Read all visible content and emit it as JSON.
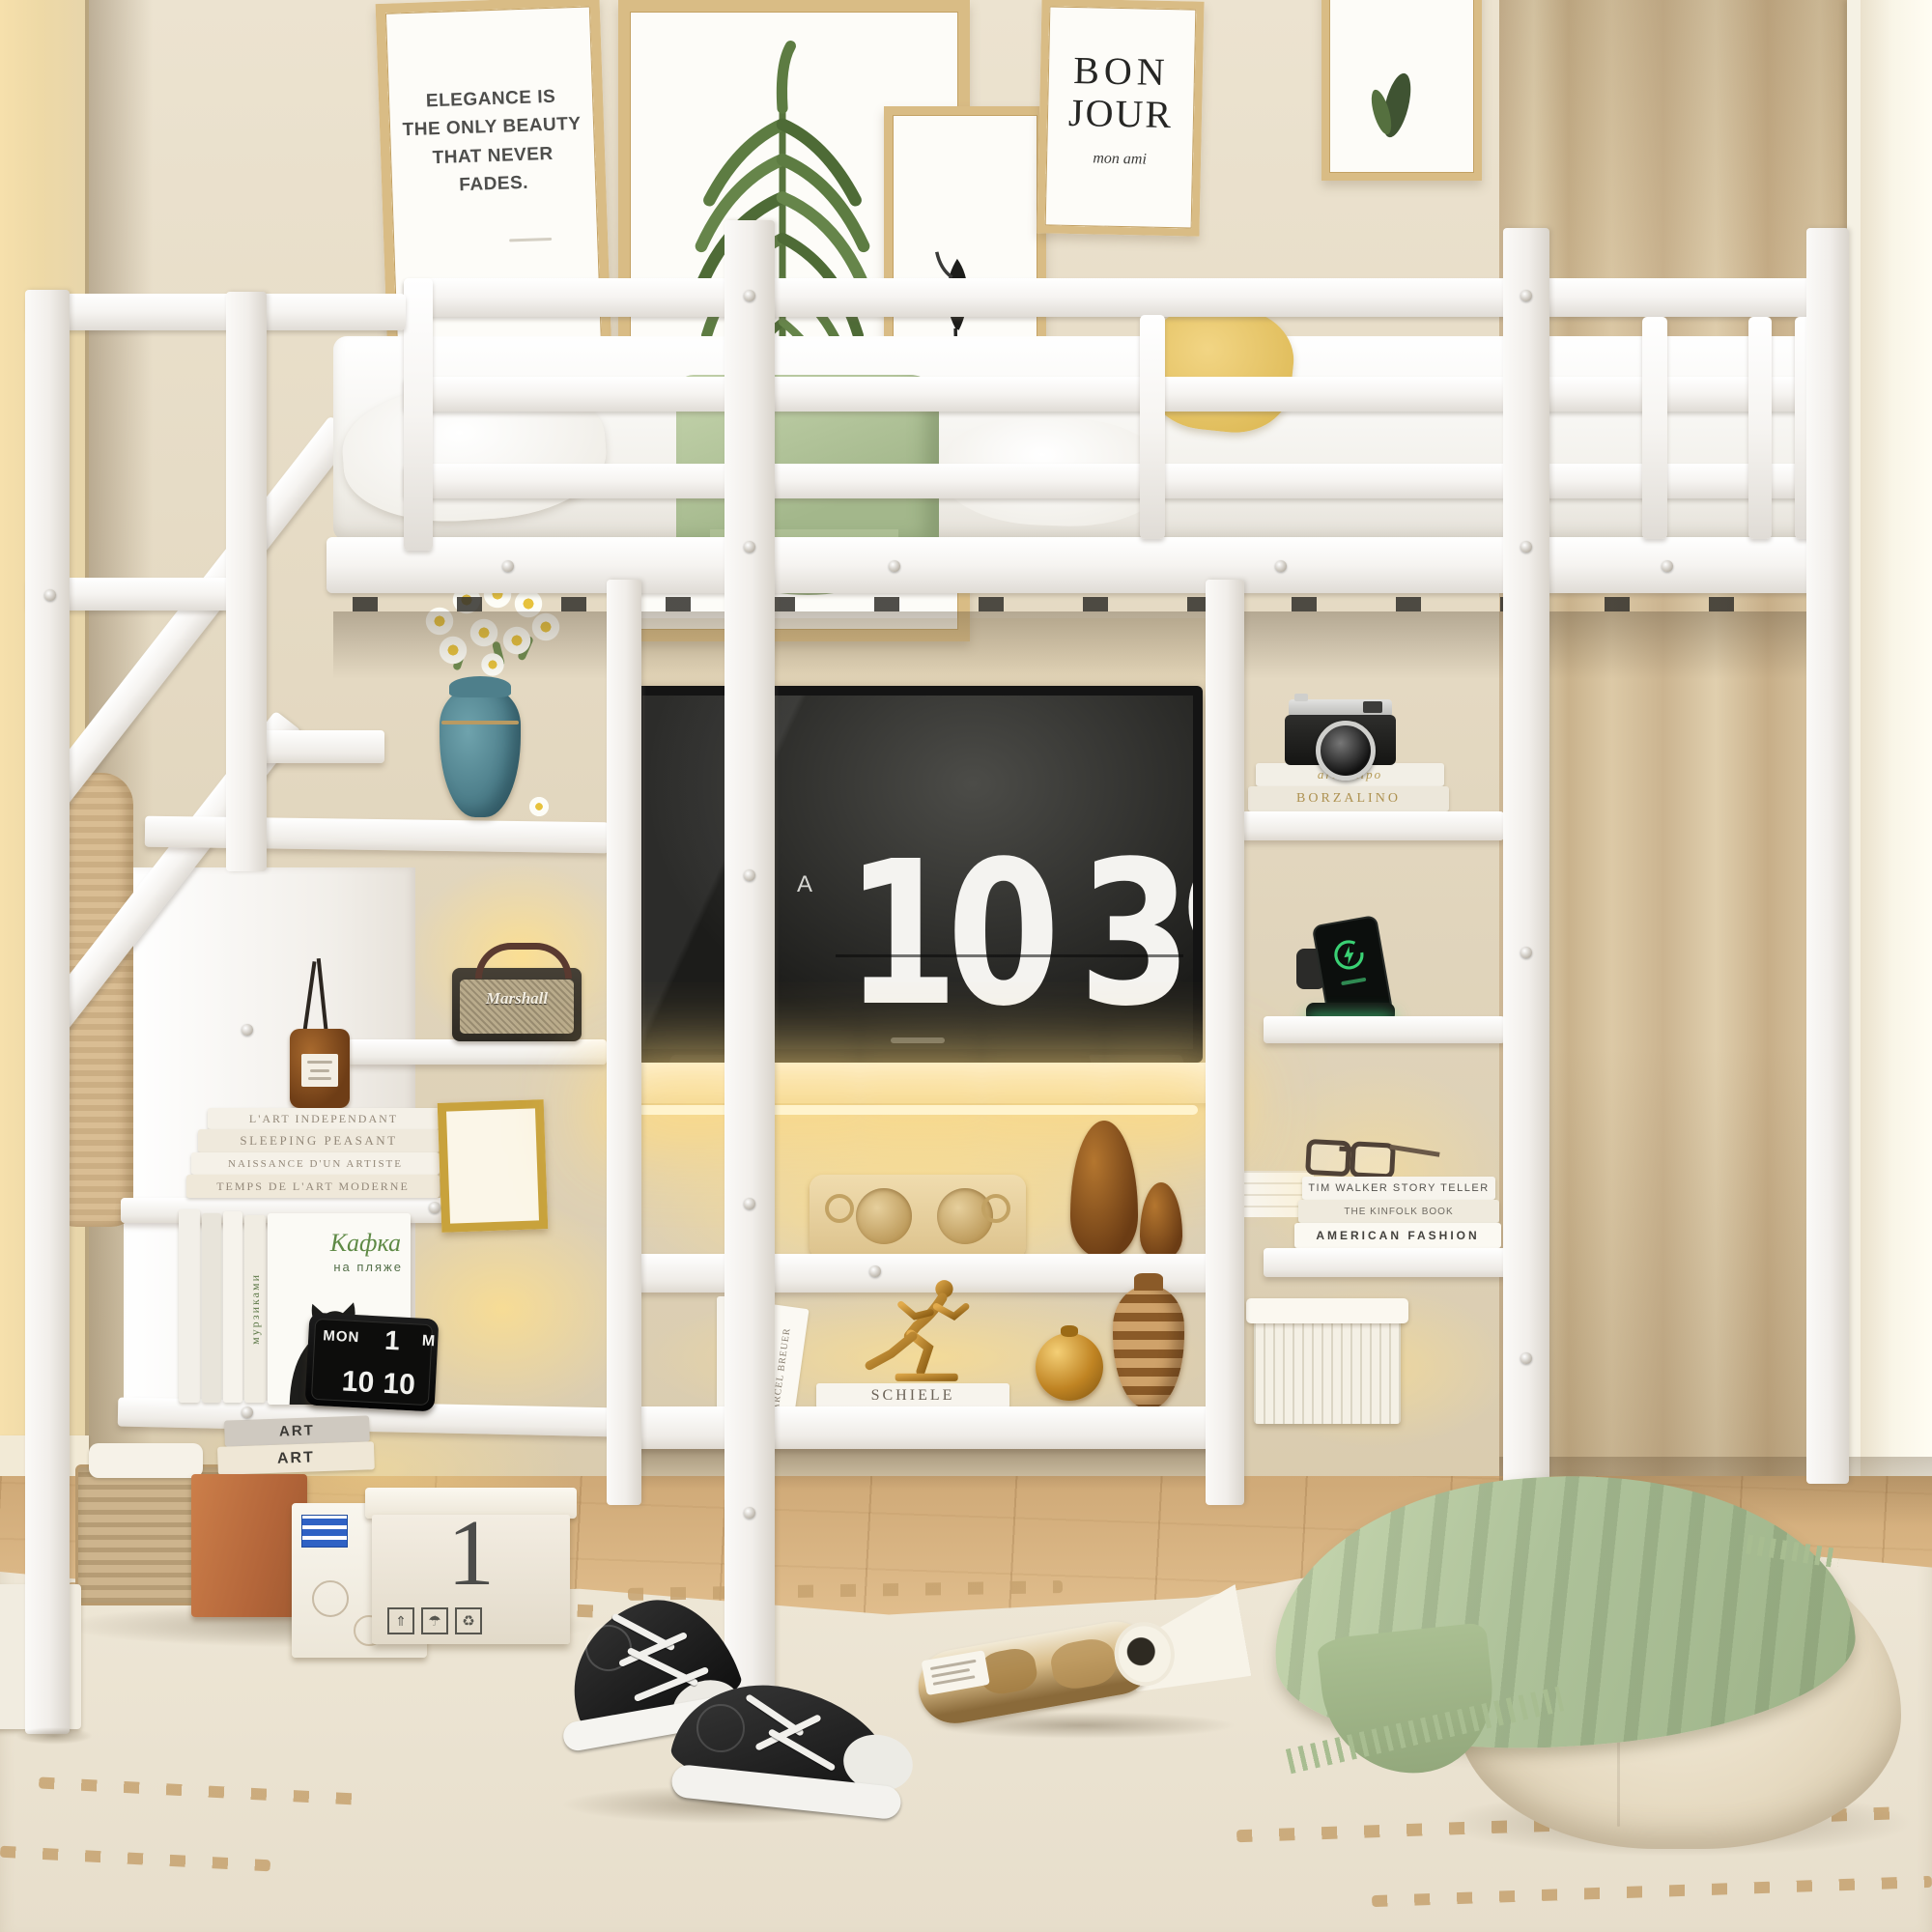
{
  "wall_art": {
    "quote": "ELEGANCE IS\nTHE ONLY BEAUTY\nTHAT NEVER\nFADES.",
    "bonjour_top": "BON",
    "bonjour_bottom": "JOUR",
    "bonjour_script": "mon ami"
  },
  "tv": {
    "ampm": "A",
    "hours": "10",
    "minutes": "39"
  },
  "left_unit": {
    "stacked_books": [
      "L'ART INDEPENDANT",
      "SLEEPING PEASANT",
      "NAISSANCE D'UN ARTISTE",
      "TEMPS DE L'ART MODERNE"
    ],
    "cat_book": {
      "title_script": "Кафка",
      "title_sub": "на пляже",
      "spine_vertical": "мурзиками"
    },
    "flip_clock": {
      "day": "MON",
      "date": "1",
      "month_partial": "M",
      "hours": "10",
      "minutes": "10"
    },
    "art_book_spines": [
      "ART",
      "ART"
    ],
    "storage_box_number": "1"
  },
  "speaker": {
    "brand": "Marshall"
  },
  "center_unit": {
    "vertical_spine": "ARCHITECTURE",
    "leaning_spine": "MARCEL BREUER",
    "trophy_books": {
      "top": "SCHIELE",
      "bottom_author": "JODI PICOULT",
      "bottom_title": "second glance"
    }
  },
  "right_unit": {
    "camera_books": [
      "archetipo",
      "BORZALINO"
    ],
    "fashion_books": [
      "TIM WALKER STORY TELLER",
      "THE KINFOLK BOOK",
      "AMERICAN FASHION"
    ]
  },
  "icons": {
    "umbrella": "☂",
    "recycle": "♻",
    "arrows_up": "⇑"
  },
  "colors": {
    "frame_white": "#fbfafa",
    "wall": "#e7ddc8",
    "curtain": "#d7c3a0",
    "led_glow": "#ffe49a",
    "sage_green": "#b7c9a0",
    "wood_floor": "#dcb585",
    "gold": "#c9973b",
    "teal_vase": "#4e7f8b"
  }
}
